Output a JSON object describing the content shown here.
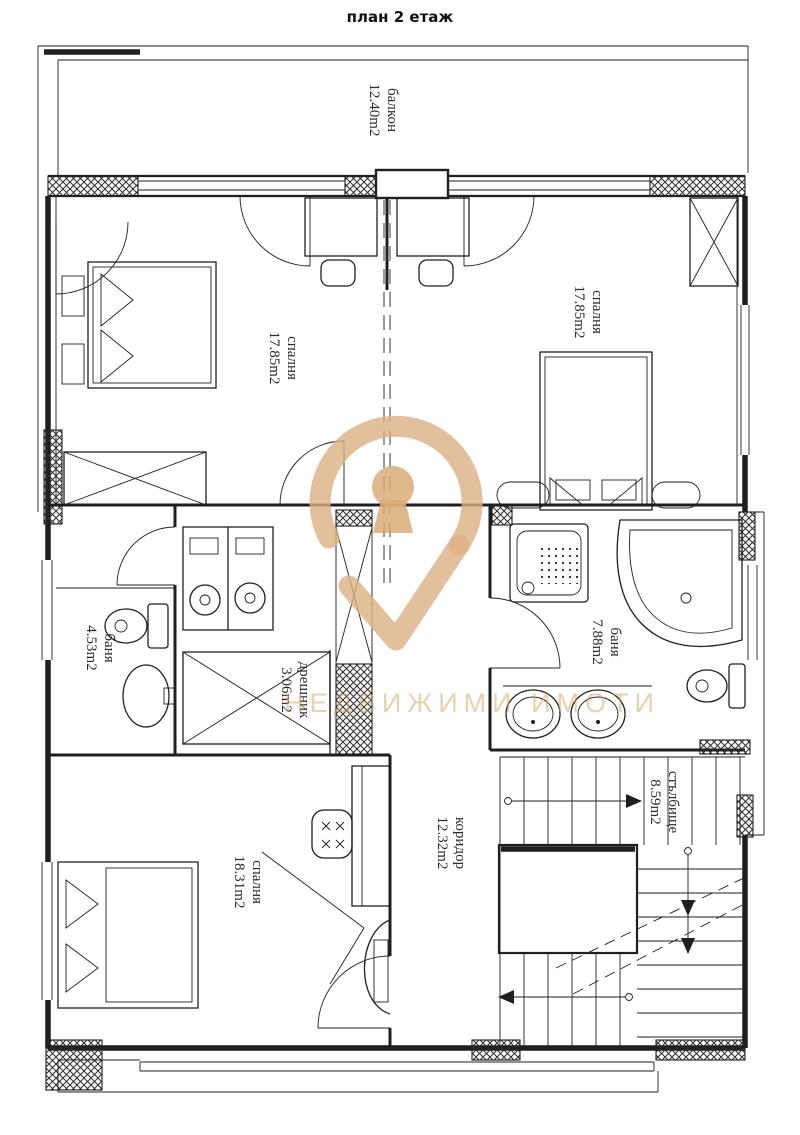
{
  "title": "план 2 етаж",
  "watermark": {
    "text": "НЕДВИЖИМИ ИМОТИ",
    "text_color": "#d8a262",
    "logo_color": "#dcb083"
  },
  "line_color": "#1f1f1f",
  "rooms": {
    "balcony": {
      "name": "балкон",
      "area": "12.40m2"
    },
    "bedroom_left": {
      "name": "спалня",
      "area": "17.85m2"
    },
    "bedroom_right": {
      "name": "спалня",
      "area": "17.85m2"
    },
    "bath_left": {
      "name": "баня",
      "area": "4.53m2"
    },
    "closet": {
      "name": "дрешник",
      "area": "3.06m2"
    },
    "bath_right": {
      "name": "баня",
      "area": "7.88m2"
    },
    "bedroom_bottom": {
      "name": "спалня",
      "area": "18.31m2"
    },
    "corridor": {
      "name": "коридор",
      "area": "12.32m2"
    },
    "staircase": {
      "name": "стълбище",
      "area": "8.59m2"
    }
  }
}
